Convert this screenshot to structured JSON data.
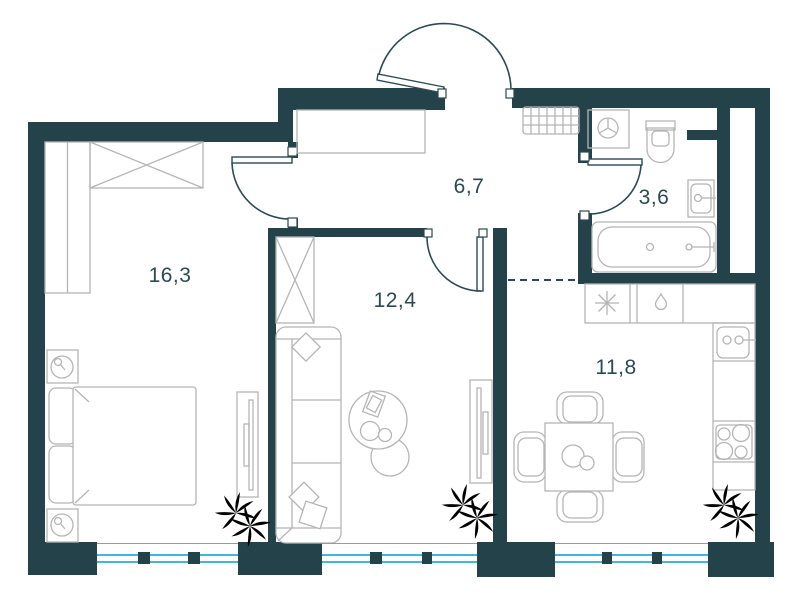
{
  "plan": {
    "type": "apartment-floor-plan",
    "rooms": [
      {
        "name": "bedroom",
        "area": "16,3"
      },
      {
        "name": "living-room",
        "area": "12,4"
      },
      {
        "name": "hallway",
        "area": "6,7"
      },
      {
        "name": "bathroom",
        "area": "3,6"
      },
      {
        "name": "kitchen",
        "area": "11,8"
      }
    ],
    "colors": {
      "wall": "#24424a",
      "room_label": "#2b4a52",
      "window_glass": "#45b5dc",
      "plant": "#4cba2b",
      "furniture_outline": "#b5b5b5"
    }
  }
}
